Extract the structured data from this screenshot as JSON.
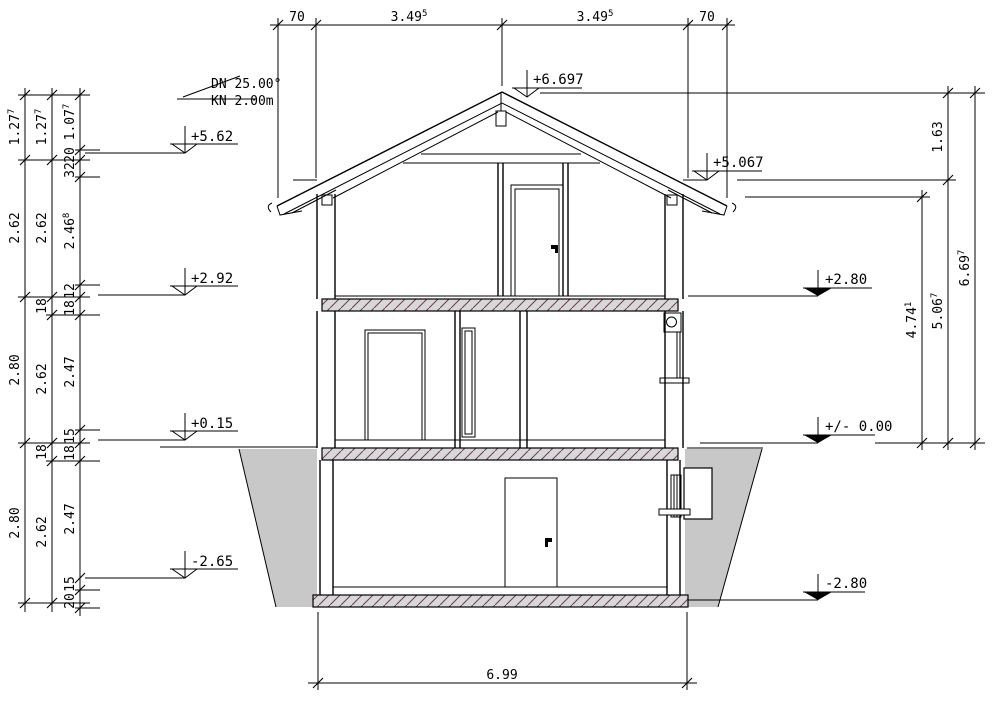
{
  "drawing": {
    "pitch_note": {
      "line1": "DN 25.00°",
      "line2": "KN 2.00m"
    }
  },
  "dims": {
    "top": [
      {
        "v": "70",
        "s": ""
      },
      {
        "v": "3.49",
        "s": "5"
      },
      {
        "v": "3.49",
        "s": "5"
      },
      {
        "v": "70",
        "s": ""
      }
    ],
    "bottom": {
      "v": "6.99",
      "s": ""
    },
    "left_outer": [
      {
        "v": "1.27",
        "s": "7"
      },
      {
        "v": "2.62",
        "s": ""
      },
      {
        "v": "2.80",
        "s": ""
      },
      {
        "v": "2.80",
        "s": ""
      }
    ],
    "left_middle": [
      {
        "v": "1.27",
        "s": "7"
      },
      {
        "v": "2.62",
        "s": ""
      },
      {
        "v": "18",
        "s": ""
      },
      {
        "v": "2.62",
        "s": ""
      },
      {
        "v": "18",
        "s": ""
      },
      {
        "v": "2.62",
        "s": ""
      }
    ],
    "left_inner": [
      {
        "v": "1.07",
        "s": "7"
      },
      {
        "v": "20",
        "s": ""
      },
      {
        "v": "32",
        "s": ""
      },
      {
        "v": "2.46",
        "s": "8"
      },
      {
        "v": "12",
        "s": ""
      },
      {
        "v": "18",
        "s": ""
      },
      {
        "v": "2.47",
        "s": ""
      },
      {
        "v": "15",
        "s": ""
      },
      {
        "v": "18",
        "s": ""
      },
      {
        "v": "2.47",
        "s": ""
      },
      {
        "v": "15",
        "s": ""
      },
      {
        "v": "20",
        "s": ""
      }
    ],
    "right_inner": [
      {
        "v": "4.74",
        "s": "1"
      }
    ],
    "right_middle": [
      {
        "v": "1.63",
        "s": ""
      },
      {
        "v": "5.06",
        "s": "7"
      }
    ],
    "right_outer": [
      {
        "v": "6.69",
        "s": "7"
      }
    ]
  },
  "levels": {
    "ridge": "+6.697",
    "eaves": "+5.067",
    "left": [
      "+5.62",
      "+2.92",
      "+0.15",
      "-2.65"
    ],
    "right": [
      "+2.80",
      "+/- 0.00",
      "-2.80"
    ]
  },
  "colors": {
    "line": "#000000",
    "soil": "#c8c8c8",
    "slab": "#d8d8d8",
    "hatch": "#6e3a5a",
    "paper": "#ffffff"
  }
}
